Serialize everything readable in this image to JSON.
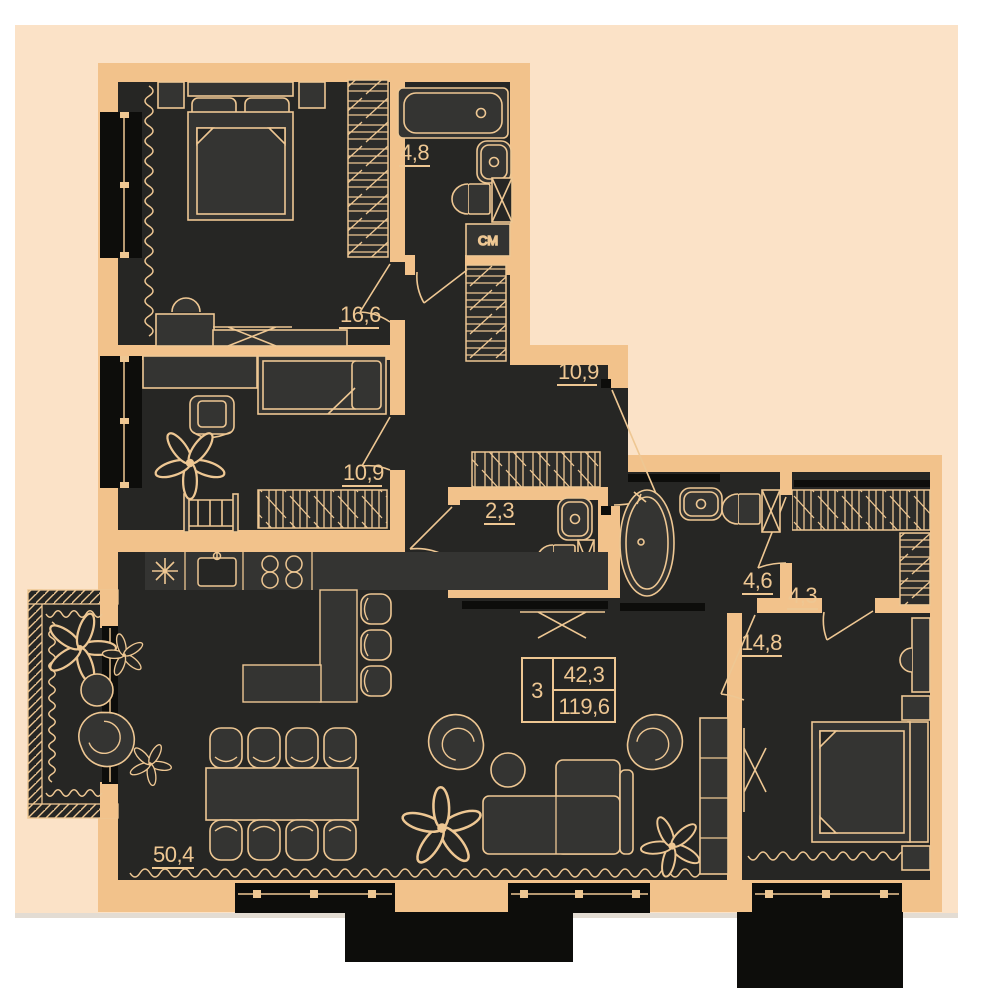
{
  "plan": {
    "title": "apartment-floor-plan",
    "apartment_info": {
      "rooms_count": "3",
      "living_area": "42,3",
      "total_area": "119,6"
    },
    "rooms": {
      "bedroom_main": {
        "area": "16,6"
      },
      "bathroom_top": {
        "area": "4,8"
      },
      "kids_room": {
        "area": "10,9"
      },
      "hallway": {
        "area": "10,9"
      },
      "wc": {
        "area": "2,3"
      },
      "bathroom_master": {
        "area": "4,6"
      },
      "wardrobe_room": {
        "area": "4,3"
      },
      "bedroom_second": {
        "area": "14,8"
      },
      "living_kitchen": {
        "area": "50,4"
      }
    },
    "labels": {
      "washing_machine": "СМ"
    },
    "icons": {
      "bathtub": "bathtub-icon",
      "sink": "sink-icon",
      "toilet": "toilet-icon",
      "washer": "washing-machine-icon",
      "bed": "bed-icon",
      "sofa": "sofa-icon",
      "plant": "plant-icon",
      "dining_table": "dining-table-icon",
      "tv": "tv-icon",
      "wardrobe": "wardrobe-hatch-icon"
    },
    "colors": {
      "page_background": "#ffffff",
      "panel_background": "#fbe2c7",
      "wall": "#f2c28b",
      "room_fill": "#262624",
      "furniture_fill": "#343432",
      "line": "#eec793",
      "window_dark": "#0d0d0b"
    }
  }
}
